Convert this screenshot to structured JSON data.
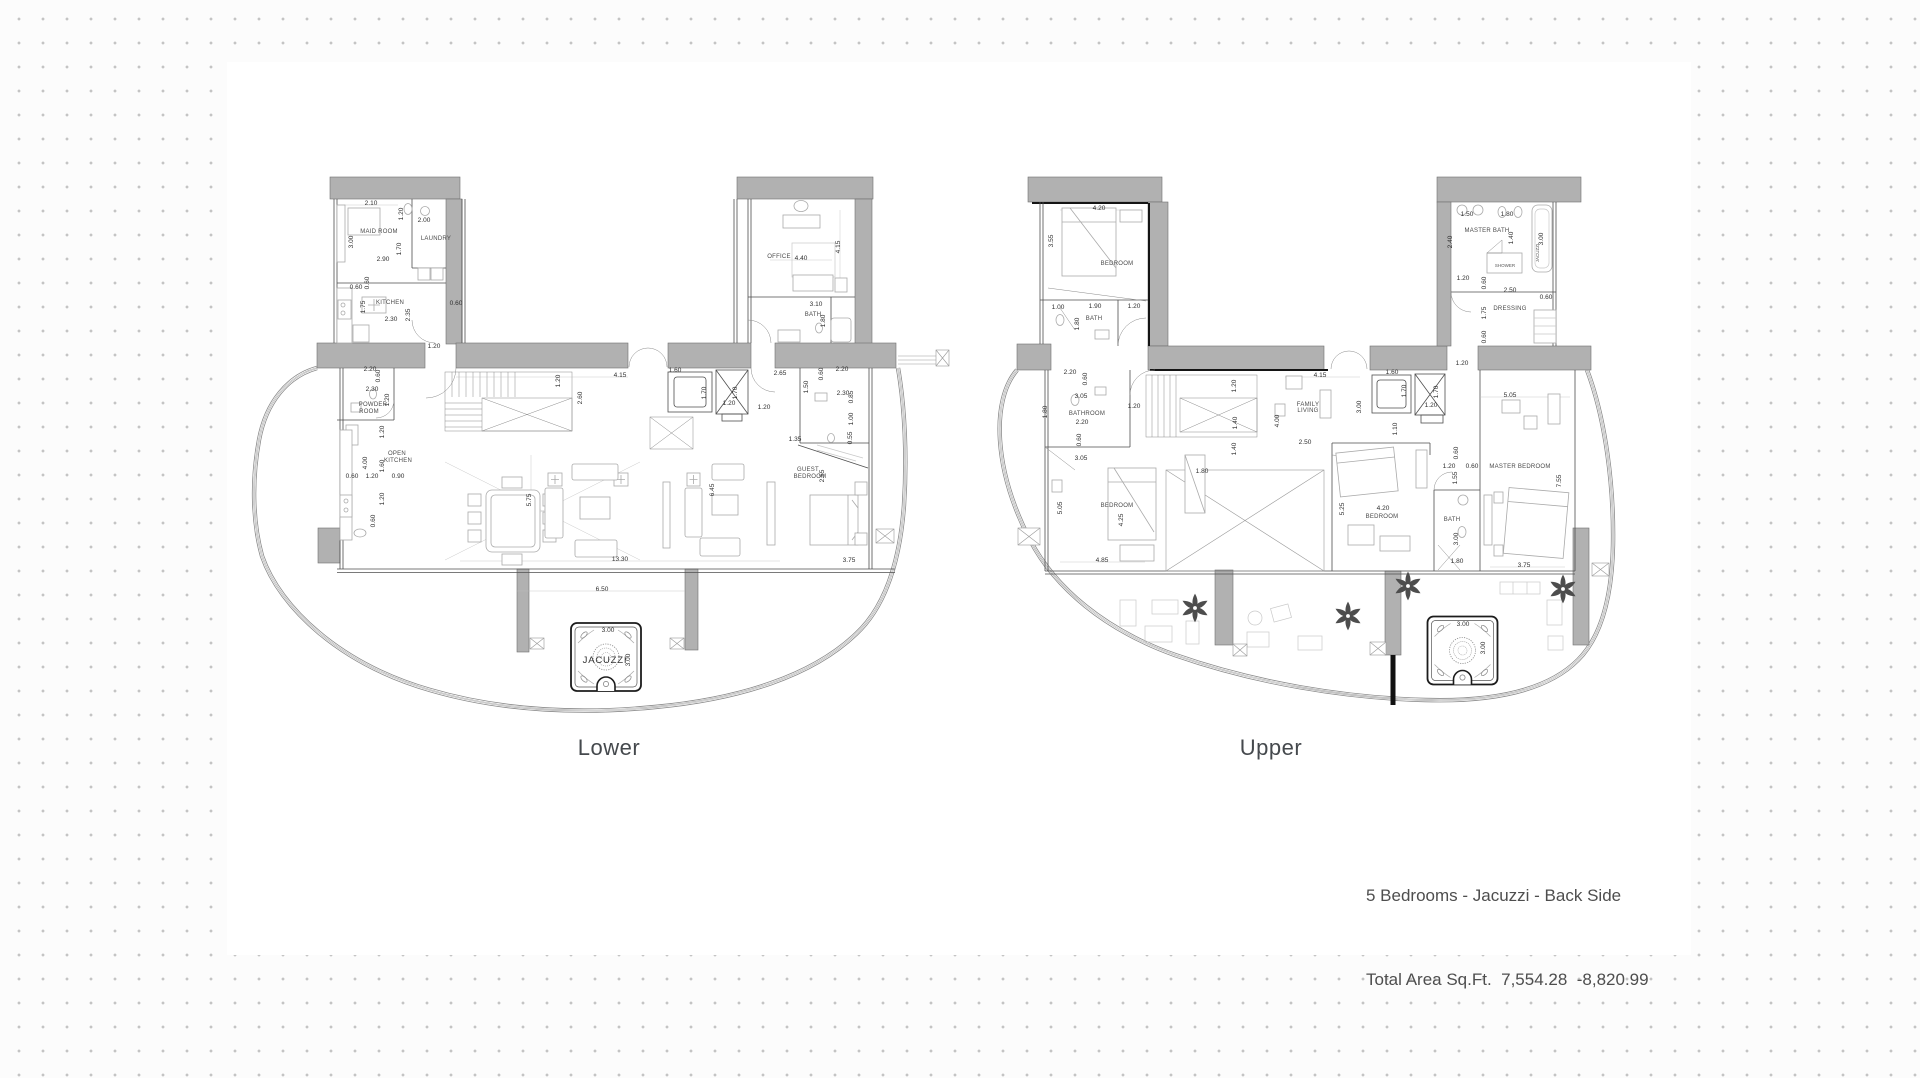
{
  "page": {
    "background": "#fcfcfc",
    "dot_color": "#c4c4c4",
    "panel_color": "#ffffff",
    "wall_color": "#b1b1b1",
    "line_color": "#4f4f4f"
  },
  "caption": {
    "line1": "5 Bedrooms - Jacuzzi - Back Side",
    "line2": "Total Area Sq.Ft.  7,554.28  -8,820.99"
  },
  "plans": {
    "lower": {
      "label": "Lower",
      "plants": [],
      "texts": [
        {
          "t": "2.10",
          "x": 371,
          "y": 205
        },
        {
          "t": "1.20",
          "x": 403,
          "y": 214,
          "r": 1
        },
        {
          "t": "2.00",
          "x": 424,
          "y": 222
        },
        {
          "t": "3.00",
          "x": 353,
          "y": 242,
          "r": 1
        },
        {
          "t": "MAID ROOM",
          "x": 379,
          "y": 233,
          "k": "room"
        },
        {
          "t": "1.70",
          "x": 401,
          "y": 249,
          "r": 1
        },
        {
          "t": "LAUNDRY",
          "x": 436,
          "y": 240,
          "k": "room"
        },
        {
          "t": "2.90",
          "x": 383,
          "y": 261
        },
        {
          "t": "0.60",
          "x": 369,
          "y": 283,
          "r": 1
        },
        {
          "t": "0.60",
          "x": 356,
          "y": 289
        },
        {
          "t": "KITCHEN",
          "x": 390,
          "y": 304,
          "k": "room"
        },
        {
          "t": "1.75",
          "x": 365,
          "y": 307,
          "r": 1
        },
        {
          "t": "2.35",
          "x": 410,
          "y": 315,
          "r": 1
        },
        {
          "t": "2.30",
          "x": 391,
          "y": 321
        },
        {
          "t": "0.60",
          "x": 456,
          "y": 305
        },
        {
          "t": "1.20",
          "x": 434,
          "y": 348
        },
        {
          "t": "OFFICE",
          "x": 779,
          "y": 258,
          "k": "room"
        },
        {
          "t": "4.40",
          "x": 801,
          "y": 260
        },
        {
          "t": "4.15",
          "x": 840,
          "y": 247,
          "r": 1
        },
        {
          "t": "3.10",
          "x": 816,
          "y": 306
        },
        {
          "t": "BATH",
          "x": 813,
          "y": 316,
          "k": "room"
        },
        {
          "t": "1.80",
          "x": 825,
          "y": 321,
          "r": 1
        },
        {
          "t": "4.15",
          "x": 620,
          "y": 377
        },
        {
          "t": "1.20",
          "x": 560,
          "y": 381,
          "r": 1
        },
        {
          "t": "2.60",
          "x": 582,
          "y": 398,
          "r": 1
        },
        {
          "t": "1.60",
          "x": 675,
          "y": 372
        },
        {
          "t": "1.70",
          "x": 706,
          "y": 393,
          "r": 1
        },
        {
          "t": "1.70",
          "x": 737,
          "y": 393,
          "r": 1
        },
        {
          "t": "1.20",
          "x": 729,
          "y": 405
        },
        {
          "t": "1.20",
          "x": 764,
          "y": 409
        },
        {
          "t": "2.65",
          "x": 780,
          "y": 375
        },
        {
          "t": "1.50",
          "x": 808,
          "y": 387,
          "r": 1
        },
        {
          "t": "0.60",
          "x": 823,
          "y": 374,
          "r": 1
        },
        {
          "t": "2.20",
          "x": 842,
          "y": 371
        },
        {
          "t": "2.30",
          "x": 843,
          "y": 395
        },
        {
          "t": "0.85",
          "x": 853,
          "y": 397,
          "r": 1
        },
        {
          "t": "1.00",
          "x": 853,
          "y": 419,
          "r": 1
        },
        {
          "t": "0.55",
          "x": 852,
          "y": 438,
          "r": 1
        },
        {
          "t": "1.35",
          "x": 795,
          "y": 441
        },
        {
          "t": "GUEST",
          "x": 808,
          "y": 471,
          "k": "room"
        },
        {
          "t": "BEDROOM",
          "x": 810,
          "y": 478,
          "k": "room"
        },
        {
          "t": "2.55",
          "x": 824,
          "y": 476,
          "r": 1
        },
        {
          "t": "6.45",
          "x": 714,
          "y": 490,
          "r": 1
        },
        {
          "t": "5.75",
          "x": 531,
          "y": 500,
          "r": 1
        },
        {
          "t": "13.30",
          "x": 620,
          "y": 561
        },
        {
          "t": "3.75",
          "x": 849,
          "y": 562
        },
        {
          "t": "6.50",
          "x": 602,
          "y": 591
        },
        {
          "t": "2.20",
          "x": 370,
          "y": 371
        },
        {
          "t": "0.60",
          "x": 380,
          "y": 376,
          "r": 1
        },
        {
          "t": "2.30",
          "x": 372,
          "y": 391
        },
        {
          "t": "1.20",
          "x": 389,
          "y": 400,
          "r": 1
        },
        {
          "t": "POWDER",
          "x": 373,
          "y": 406,
          "k": "room"
        },
        {
          "t": "ROOM",
          "x": 369,
          "y": 413,
          "k": "room"
        },
        {
          "t": "1.20",
          "x": 384,
          "y": 432,
          "r": 1
        },
        {
          "t": "OPEN",
          "x": 397,
          "y": 455,
          "k": "room"
        },
        {
          "t": "KITCHEN",
          "x": 398,
          "y": 462,
          "k": "room"
        },
        {
          "t": "4.00",
          "x": 367,
          "y": 463,
          "r": 1
        },
        {
          "t": "1.60",
          "x": 384,
          "y": 466,
          "r": 1
        },
        {
          "t": "0.60",
          "x": 352,
          "y": 478
        },
        {
          "t": "1.20",
          "x": 372,
          "y": 478
        },
        {
          "t": "0.90",
          "x": 398,
          "y": 478
        },
        {
          "t": "1.20",
          "x": 384,
          "y": 499,
          "r": 1
        },
        {
          "t": "0.60",
          "x": 375,
          "y": 521,
          "r": 1
        },
        {
          "t": "3.00",
          "x": 608,
          "y": 632
        },
        {
          "t": "3.00",
          "x": 630,
          "y": 660,
          "r": 1
        },
        {
          "t": "JACUZZI",
          "x": 605,
          "y": 663,
          "k": "jz"
        }
      ]
    },
    "upper": {
      "label": "Upper",
      "plants": [
        {
          "x": 1195,
          "y": 608
        },
        {
          "x": 1408,
          "y": 586
        },
        {
          "x": 1563,
          "y": 589
        },
        {
          "x": 1348,
          "y": 616
        }
      ],
      "texts": [
        {
          "t": "4.20",
          "x": 1099,
          "y": 210
        },
        {
          "t": "3.55",
          "x": 1053,
          "y": 241,
          "r": 1
        },
        {
          "t": "BEDROOM",
          "x": 1117,
          "y": 265,
          "k": "room"
        },
        {
          "t": "1.00",
          "x": 1058,
          "y": 309
        },
        {
          "t": "1.90",
          "x": 1095,
          "y": 308
        },
        {
          "t": "1.20",
          "x": 1134,
          "y": 308
        },
        {
          "t": "BATH",
          "x": 1094,
          "y": 320,
          "k": "room"
        },
        {
          "t": "1.80",
          "x": 1079,
          "y": 324,
          "r": 1
        },
        {
          "t": "1.50",
          "x": 1467,
          "y": 216
        },
        {
          "t": "1.80",
          "x": 1507,
          "y": 216
        },
        {
          "t": "MASTER BATH",
          "x": 1487,
          "y": 232,
          "k": "room"
        },
        {
          "t": "2.40",
          "x": 1452,
          "y": 242,
          "r": 1
        },
        {
          "t": "1.40",
          "x": 1513,
          "y": 238,
          "r": 1
        },
        {
          "t": "3.00",
          "x": 1543,
          "y": 239,
          "r": 1
        },
        {
          "t": "JACUZZI",
          "x": 1539,
          "y": 253,
          "r": 1,
          "k": "rs"
        },
        {
          "t": "SHOWER",
          "x": 1505,
          "y": 267,
          "k": "rs"
        },
        {
          "t": "1.20",
          "x": 1463,
          "y": 280
        },
        {
          "t": "0.60",
          "x": 1486,
          "y": 283,
          "r": 1
        },
        {
          "t": "2.50",
          "x": 1510,
          "y": 292
        },
        {
          "t": "0.60",
          "x": 1546,
          "y": 299
        },
        {
          "t": "DRESSING",
          "x": 1510,
          "y": 310,
          "k": "room"
        },
        {
          "t": "1.75",
          "x": 1486,
          "y": 313,
          "r": 1
        },
        {
          "t": "0.60",
          "x": 1486,
          "y": 337,
          "r": 1
        },
        {
          "t": "1.20",
          "x": 1462,
          "y": 365
        },
        {
          "t": "2.20",
          "x": 1070,
          "y": 374
        },
        {
          "t": "0.60",
          "x": 1087,
          "y": 379,
          "r": 1
        },
        {
          "t": "3.05",
          "x": 1081,
          "y": 398
        },
        {
          "t": "1.80",
          "x": 1047,
          "y": 412,
          "r": 1
        },
        {
          "t": "BATHROOM",
          "x": 1087,
          "y": 415,
          "k": "room"
        },
        {
          "t": "2.20",
          "x": 1082,
          "y": 424
        },
        {
          "t": "0.60",
          "x": 1081,
          "y": 440,
          "r": 1
        },
        {
          "t": "3.05",
          "x": 1081,
          "y": 460
        },
        {
          "t": "1.20",
          "x": 1134,
          "y": 408
        },
        {
          "t": "1.20",
          "x": 1236,
          "y": 386,
          "r": 1
        },
        {
          "t": "1.40",
          "x": 1237,
          "y": 423,
          "r": 1
        },
        {
          "t": "1.40",
          "x": 1236,
          "y": 449,
          "r": 1
        },
        {
          "t": "4.00",
          "x": 1279,
          "y": 421,
          "r": 1
        },
        {
          "t": "4.15",
          "x": 1320,
          "y": 377
        },
        {
          "t": "FAMILY",
          "x": 1308,
          "y": 406,
          "k": "room"
        },
        {
          "t": "LIVING",
          "x": 1308,
          "y": 412,
          "k": "room"
        },
        {
          "t": "3.00",
          "x": 1361,
          "y": 407,
          "r": 1
        },
        {
          "t": "2.50",
          "x": 1305,
          "y": 444
        },
        {
          "t": "1.10",
          "x": 1397,
          "y": 429,
          "r": 1
        },
        {
          "t": "1.60",
          "x": 1392,
          "y": 374
        },
        {
          "t": "1.70",
          "x": 1406,
          "y": 391,
          "r": 1
        },
        {
          "t": "1.70",
          "x": 1438,
          "y": 392,
          "r": 1
        },
        {
          "t": "1.20",
          "x": 1431,
          "y": 407
        },
        {
          "t": "5.05",
          "x": 1510,
          "y": 397
        },
        {
          "t": "MASTER BEDROOM",
          "x": 1520,
          "y": 468,
          "k": "room"
        },
        {
          "t": "7.55",
          "x": 1561,
          "y": 481,
          "r": 1
        },
        {
          "t": "0.60",
          "x": 1458,
          "y": 453,
          "r": 1
        },
        {
          "t": "1.20",
          "x": 1449,
          "y": 468
        },
        {
          "t": "0.60",
          "x": 1472,
          "y": 468
        },
        {
          "t": "1.55",
          "x": 1457,
          "y": 478,
          "r": 1
        },
        {
          "t": "1.80",
          "x": 1202,
          "y": 473
        },
        {
          "t": "BEDROOM",
          "x": 1117,
          "y": 507,
          "k": "room"
        },
        {
          "t": "5.05",
          "x": 1062,
          "y": 508,
          "r": 1
        },
        {
          "t": "4.25",
          "x": 1123,
          "y": 520,
          "r": 1
        },
        {
          "t": "4.85",
          "x": 1102,
          "y": 562
        },
        {
          "t": "4.20",
          "x": 1383,
          "y": 510
        },
        {
          "t": "BEDROOM",
          "x": 1382,
          "y": 518,
          "k": "room"
        },
        {
          "t": "5.25",
          "x": 1344,
          "y": 509,
          "r": 1
        },
        {
          "t": "BATH",
          "x": 1452,
          "y": 521,
          "k": "room"
        },
        {
          "t": "3.00",
          "x": 1458,
          "y": 539,
          "r": 1
        },
        {
          "t": "1.80",
          "x": 1457,
          "y": 563
        },
        {
          "t": "3.75",
          "x": 1524,
          "y": 567
        },
        {
          "t": "3.00",
          "x": 1463,
          "y": 626
        },
        {
          "t": "3.00",
          "x": 1485,
          "y": 648,
          "r": 1
        }
      ]
    }
  }
}
